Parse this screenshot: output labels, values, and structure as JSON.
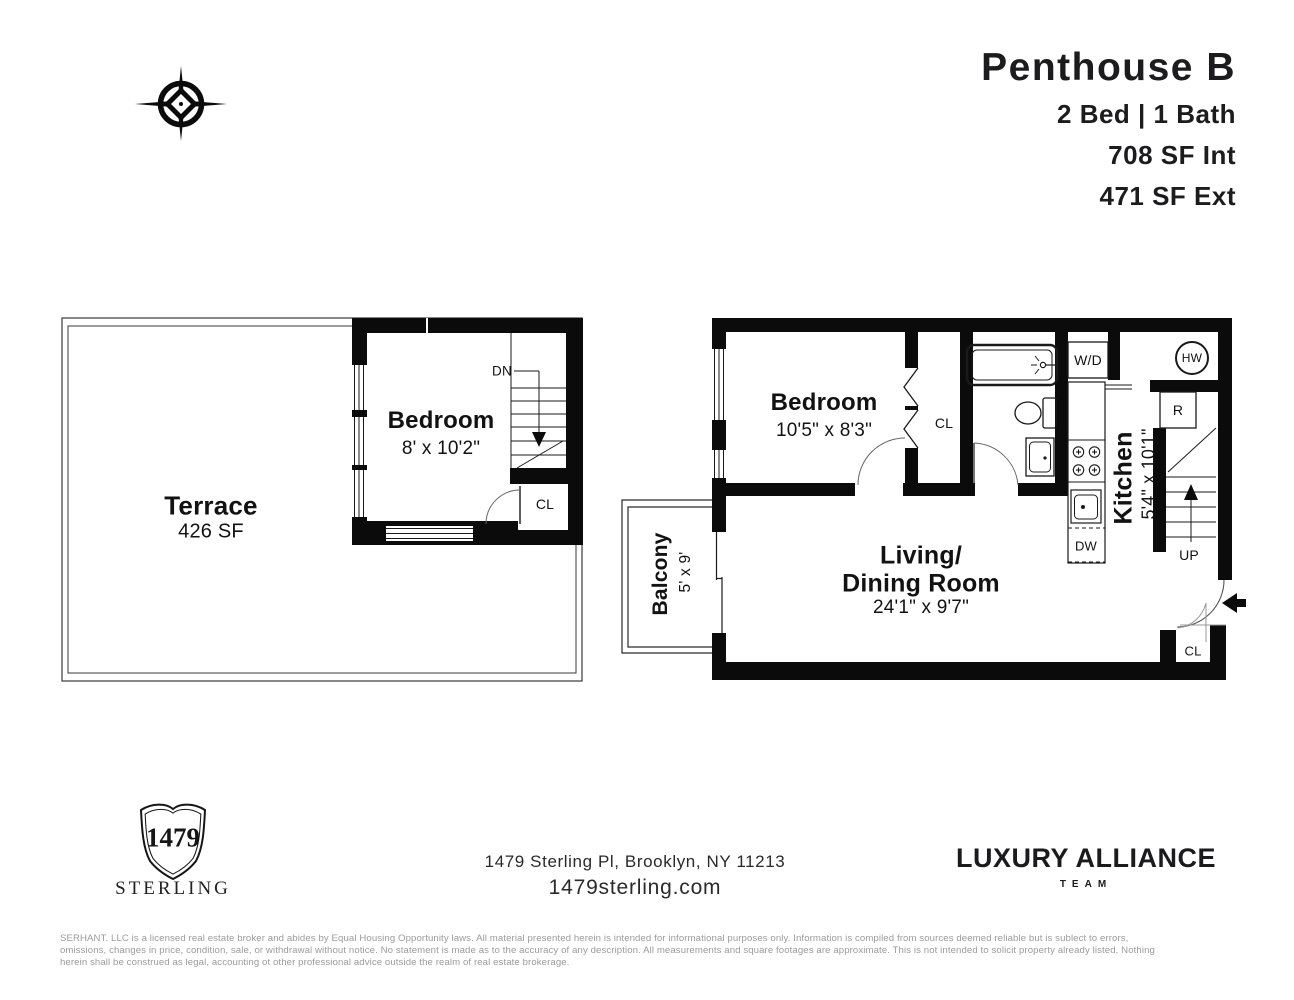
{
  "header": {
    "title": "Penthouse B",
    "beds_baths": "2 Bed | 1 Bath",
    "interior_sf": "708 SF Int",
    "exterior_sf": "471 SF Ext"
  },
  "compass": {
    "north": "N",
    "east": "E",
    "south": "S",
    "west": "W"
  },
  "upper_plan": {
    "terrace_name": "Terrace",
    "terrace_area": "426 SF",
    "bedroom_name": "Bedroom",
    "bedroom_dims": "8' x 10'2\"",
    "stairs_down": "DN",
    "closet": "CL"
  },
  "main_plan": {
    "bedroom_name": "Bedroom",
    "bedroom_dims": "10'5\" x 8'3\"",
    "living_line1": "Living/",
    "living_line2": "Dining Room",
    "living_dims": "24'1\" x 9'7\"",
    "kitchen_name": "Kitchen",
    "kitchen_dims": "5'4\" x 10'1\"",
    "balcony_name": "Balcony",
    "balcony_dims": "5' x 9'",
    "bedroom_closet": "CL",
    "entry_closet": "CL",
    "washer_dryer": "W/D",
    "hot_water": "HW",
    "refrigerator": "R",
    "dishwasher": "DW",
    "stairs_up": "UP"
  },
  "footer": {
    "logo_number": "1479",
    "logo_name": "STERLING",
    "address": "1479 Sterling Pl, Brooklyn, NY 11213",
    "website": "1479sterling.com",
    "team_name": "LUXURY ALLIANCE",
    "team_sub": "TEAM",
    "disclaimer_line1": "SERHANT. LLC is a licensed real estate broker and abides by Equal Housing Opportunity laws. All material presented herein is intended for informational purposes only. Information is compiled from sources deemed reliable but is sublect to errors,",
    "disclaimer_line2": "omissions, changes in price, condition, sale, or withdrawal without notice. No statement is made as to the accuracy of any description. All measurements and square footages are approximate. This is not intended to solicit property already listed. Nothing",
    "disclaimer_line3": "herein shall be construed as legal, accounting ot other professional advice outside the realm of real estate brokerage."
  },
  "colors": {
    "wall": "#0b0b0b",
    "thin_line": "#1a1a1a",
    "door_arc": "#666666",
    "gray_text": "#9b9b9b"
  }
}
